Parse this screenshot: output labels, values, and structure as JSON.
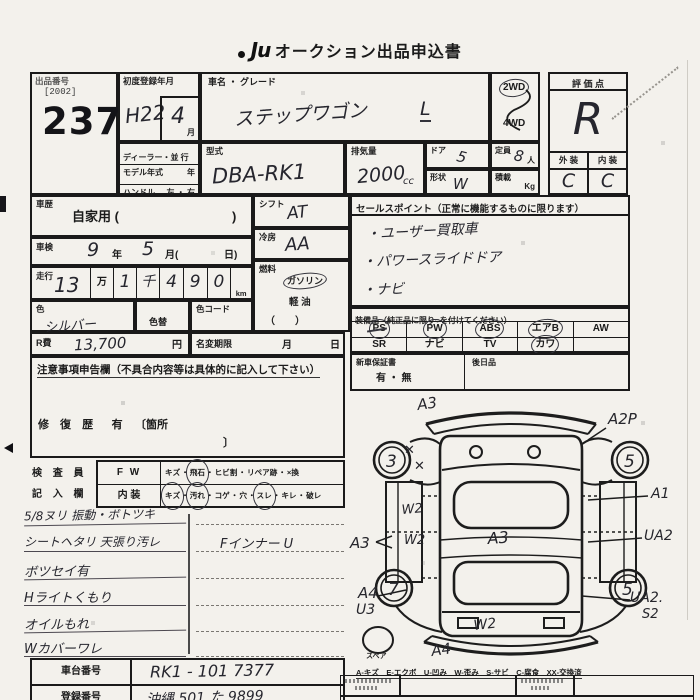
{
  "title": {
    "logo": "Ju",
    "text": "オークション出品申込書"
  },
  "sep": {
    "dot": "・"
  },
  "top": {
    "exhibit_label": "出品番号",
    "exhibit_code": "[2002]",
    "exhibit_no": "237",
    "first_reg_label": "初度登録年月",
    "first_reg": "H22",
    "first_reg_month": "4",
    "month_unit": "月",
    "dealer_row": "ディーラー・並 行",
    "model_year_label": "モデル年式",
    "year_unit": "年",
    "handle_label": "ハンドル",
    "handle_opts": "左 ・ 右",
    "car_label": "車名 ・ グレード",
    "car_name": "ステップワゴン",
    "grade": "L",
    "model_code_label": "型式",
    "model_code": "DBA-RK1",
    "displacement_label": "排気量",
    "displacement": "2000",
    "displacement_unit": "cc",
    "door_label": "ドア",
    "door": "5",
    "shape_label": "形状",
    "shape": "W",
    "capacity_label": "定員",
    "capacity": "8",
    "capacity_unit": "人",
    "load_label": "積載",
    "load_unit": "Kg",
    "drive2": "2WD",
    "drive4": "4WD",
    "rating_label": "評 価 点",
    "rating": "R",
    "exterior_label": "外 装",
    "interior_label": "内 装",
    "exterior_grade": "C",
    "interior_grade": "C"
  },
  "left": {
    "history_label": "車歴",
    "history_value": "自家用 (",
    "history_close": ")",
    "shaken_label": "車検",
    "shaken_year": "9",
    "shaken_year_unit": "年",
    "shaken_month": "5",
    "shaken_month_unit": "月(",
    "shaken_day_unit": "日)",
    "mileage_label": "走行",
    "mileage_man": "13",
    "man_unit": "万",
    "mileage_sen": "1",
    "sen_unit": "千",
    "digit1": "4",
    "digit2": "9",
    "digit3": "0",
    "km_unit": "km",
    "color_label": "色",
    "color": "シルバー",
    "recolor_label": "色替",
    "colorcode_label": "色コード",
    "rfee_label": "R費",
    "rfee": "13,700",
    "yen_unit": "円",
    "namechange_label": "名変期限",
    "month_unit": "月",
    "day_unit": "日",
    "notice_header": "注意事項申告欄（不具合内容等は具体的に記入して下さい）",
    "repair_label": "修 復 歴",
    "repair_value": "有",
    "repair_loc_open": "〔箇所",
    "repair_loc_close": "〕",
    "inspector_line1": "検 査 員",
    "inspector_line2": "記 入 欄",
    "fw_label": "F W",
    "interior_row_label": "内 装",
    "fw_opts": [
      "キズ",
      "飛石",
      "ヒビ割",
      "リペア跡",
      "×換"
    ],
    "int_opts": [
      "キズ",
      "汚れ",
      "コゲ",
      "穴",
      "スレ",
      "キレ",
      "破レ"
    ]
  },
  "notes": {
    "lines": [
      "5/8ヌリ 振動・ボトツキ",
      "シートヘタリ 天張り汚レ",
      "ボツセイ有",
      "Hライトくもり",
      "オイルもれ",
      "Wカバーワレ"
    ],
    "right_note": "Fインナー U"
  },
  "mid": {
    "shift_label": "シフト",
    "shift": "AT",
    "ac_label": "冷房",
    "ac": "AA",
    "fuel_label": "燃料",
    "fuel_gas": "ガソリン",
    "fuel_diesel": "軽 油",
    "fuel_other": "（　　）"
  },
  "sales": {
    "header": "セールスポイント（正常に機能するものに限ります）",
    "points": [
      "・ユーザー買取車",
      "・パワースライドドア",
      "・ナビ"
    ]
  },
  "equip": {
    "header": "装備品（純正品に限り○を付けてください）",
    "row1": [
      "PS",
      "PW",
      "ABS",
      "エアB",
      "AW"
    ],
    "row2": [
      "SR",
      "ナビ",
      "TV",
      "カワ",
      ""
    ]
  },
  "warranty": {
    "label": "新車保証書",
    "options": "有 ・ 無",
    "later_label": "後日品"
  },
  "bottom": {
    "chassis_label": "車台番号",
    "chassis": "RK1 - 101 7377",
    "reg_label": "登録番号",
    "reg": "沖縄 501 た 9899"
  },
  "diagram": {
    "front": "A3",
    "front_right": "A2P",
    "x1": "✕",
    "x2": "✕",
    "wheel_fl": "3",
    "wheel_fr": "5",
    "wheel_rl": "7",
    "wheel_rr": "5",
    "right1": "A1",
    "right2": "UA2",
    "right3": "UA2.",
    "right3b": "S2",
    "left_w2a": "W2",
    "left_w2b": "W2",
    "left_a3": "A3",
    "center": "A3",
    "rear_left": "A4",
    "rear_left2": "U3",
    "rear_w2": "W2",
    "rear": "A4",
    "spare": "スペア",
    "legend": "A-キズ　E-エクボ　U-凹み　W-歪み　S-サビ　C-腐食　XX-交換済"
  },
  "colors": {
    "ink": "#1a1a1a",
    "pen": "#26262e",
    "paper": "#f3f1ec"
  }
}
